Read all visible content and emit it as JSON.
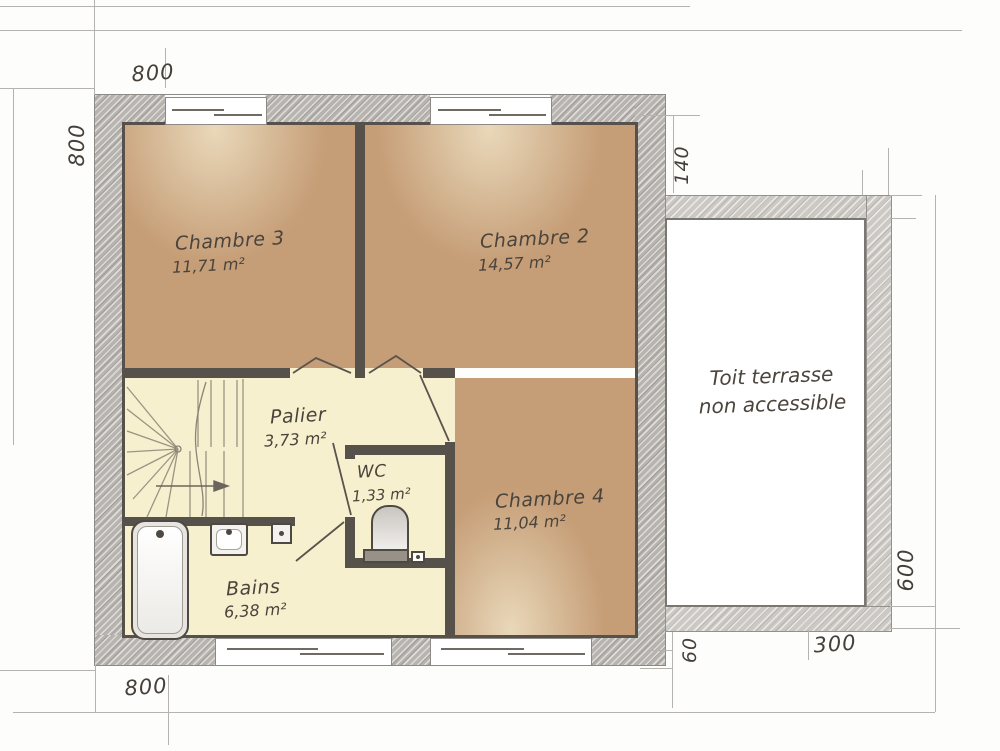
{
  "rooms": [
    {
      "name": "Chambre 3",
      "area": "11,71 m²"
    },
    {
      "name": "Chambre 2",
      "area": "14,57 m²"
    },
    {
      "name": "Chambre 4",
      "area": "11,04 m²"
    },
    {
      "name": "Palier",
      "area": "3,73 m²"
    },
    {
      "name": "WC",
      "area": "1,33 m²"
    },
    {
      "name": "Bains",
      "area": "6,38 m²"
    }
  ],
  "terrace": {
    "label_line1": "Toit terrasse",
    "label_line2": "non accessible"
  },
  "dimensions": {
    "top": "800",
    "left": "800",
    "right_gap": "140",
    "terrace_height": "600",
    "terrace_width": "300",
    "bottom_offset": "60",
    "bottom": "800"
  },
  "colors": {
    "exterior_wall": "#b7b3ae",
    "terrace_wall": "#ccc8c3",
    "partition": "#57514b",
    "bedroom_floor": "#c59d76",
    "service_floor": "#f6f0cf",
    "text": "#4a443c"
  }
}
